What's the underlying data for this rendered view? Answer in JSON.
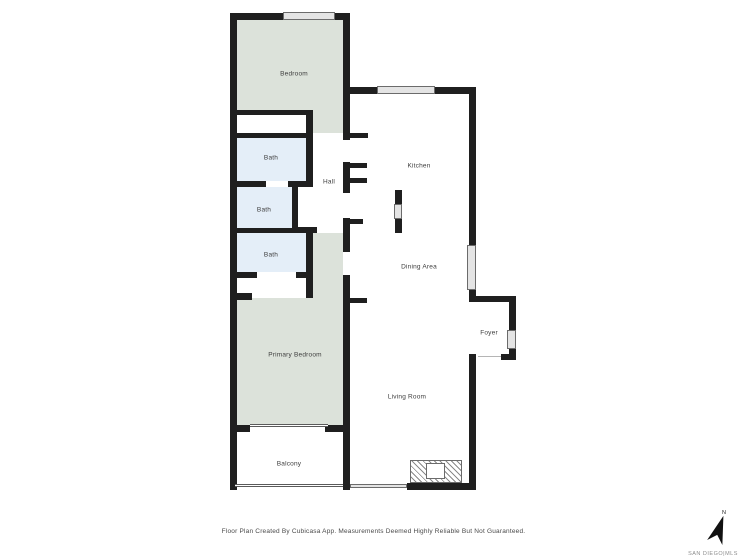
{
  "canvas": {
    "width": 747,
    "height": 560
  },
  "colors": {
    "wall": "#1f1f1f",
    "room_green": "#dce2da",
    "room_blue": "#e4eef8",
    "window_fill": "#e4e4e4",
    "window_border": "#6b6b6b",
    "rail_border": "#5a5a5a",
    "hatch_line": "#8a8a8a",
    "label": "#3d3d3d",
    "footer_text": "#4a4a4a",
    "brand_text": "#8d8d8d"
  },
  "rooms": [
    {
      "name": "bedroom",
      "label": "Bedroom",
      "cx": 294,
      "cy": 74
    },
    {
      "name": "bath-upper",
      "label": "Bath",
      "cx": 271,
      "cy": 158
    },
    {
      "name": "hall",
      "label": "Hall",
      "cx": 329,
      "cy": 182
    },
    {
      "name": "bath-middle",
      "label": "Bath",
      "cx": 264,
      "cy": 210
    },
    {
      "name": "bath-lower",
      "label": "Bath",
      "cx": 271,
      "cy": 255
    },
    {
      "name": "kitchen",
      "label": "Kitchen",
      "cx": 419,
      "cy": 166
    },
    {
      "name": "dining-area",
      "label": "Dining Area",
      "cx": 419,
      "cy": 267
    },
    {
      "name": "foyer",
      "label": "Foyer",
      "cx": 489,
      "cy": 333
    },
    {
      "name": "primary-bedroom",
      "label": "Primary Bedroom",
      "cx": 295,
      "cy": 355
    },
    {
      "name": "living-room",
      "label": "Living Room",
      "cx": 407,
      "cy": 397
    },
    {
      "name": "balcony",
      "label": "Balcony",
      "cx": 289,
      "cy": 464
    }
  ],
  "footer": {
    "disclaimer": "Floor Plan Created By Cubicasa App. Measurements Deemed Highly Reliable But Not Guaranteed."
  },
  "branding": {
    "north_label": "N",
    "mls_label": "SAN DIEGO|MLS"
  },
  "geometry": {
    "fills": [
      {
        "name": "bedroom-fill",
        "color": "green",
        "rect": [
          237,
          20,
          106,
          90
        ]
      },
      {
        "name": "bedroom-fill",
        "color": "green",
        "rect": [
          313,
          110,
          30,
          23
        ]
      },
      {
        "name": "bath-upper-fill",
        "color": "blue",
        "rect": [
          237,
          138,
          69,
          43
        ]
      },
      {
        "name": "bath-middle-fill",
        "color": "blue",
        "rect": [
          237,
          187,
          55,
          41
        ]
      },
      {
        "name": "bath-lower-fill",
        "color": "blue",
        "rect": [
          237,
          233,
          69,
          39
        ]
      },
      {
        "name": "primary-bedroom-fill",
        "color": "green",
        "rect": [
          313,
          233,
          30,
          192
        ]
      },
      {
        "name": "primary-bedroom-fill",
        "color": "green",
        "rect": [
          237,
          298,
          76,
          127
        ]
      }
    ],
    "walls": [
      [
        230,
        13,
        7,
        477
      ],
      [
        230,
        13,
        120,
        7
      ],
      [
        343,
        13,
        7,
        127
      ],
      [
        343,
        162,
        7,
        31
      ],
      [
        343,
        218,
        7,
        34
      ],
      [
        343,
        275,
        7,
        215
      ],
      [
        343,
        87,
        133,
        7
      ],
      [
        469,
        87,
        7,
        215
      ],
      [
        469,
        296,
        47,
        6
      ],
      [
        509,
        296,
        7,
        64
      ],
      [
        501,
        354,
        15,
        6
      ],
      [
        469,
        354,
        7,
        136
      ],
      [
        407,
        483,
        69,
        7
      ],
      [
        230,
        110,
        82,
        5
      ],
      [
        306,
        110,
        7,
        77
      ],
      [
        230,
        133,
        83,
        5
      ],
      [
        230,
        181,
        36,
        6
      ],
      [
        288,
        181,
        18,
        6
      ],
      [
        292,
        183,
        6,
        50
      ],
      [
        292,
        227,
        25,
        6
      ],
      [
        230,
        228,
        68,
        5
      ],
      [
        306,
        233,
        7,
        65
      ],
      [
        230,
        272,
        27,
        6
      ],
      [
        296,
        272,
        17,
        6
      ],
      [
        230,
        293,
        22,
        7
      ],
      [
        230,
        425,
        20,
        7
      ],
      [
        325,
        425,
        18,
        7
      ],
      [
        350,
        133,
        18,
        5
      ],
      [
        350,
        163,
        17,
        5
      ],
      [
        350,
        178,
        17,
        5
      ],
      [
        350,
        219,
        13,
        5
      ],
      [
        350,
        298,
        17,
        5
      ]
    ],
    "windows": [
      [
        283,
        12,
        52,
        8
      ],
      [
        377,
        86,
        58,
        8
      ],
      [
        467,
        245,
        9,
        45
      ],
      [
        507,
        330,
        9,
        19
      ]
    ],
    "railings": [
      [
        235,
        484,
        108,
        3
      ],
      [
        250,
        424,
        78,
        3
      ]
    ],
    "sliders": [
      [
        350,
        484,
        57,
        4
      ]
    ],
    "door_lines": [
      [
        478,
        356,
        23,
        1
      ]
    ],
    "island": {
      "top": [
        395,
        190,
        7,
        14
      ],
      "mid": [
        394,
        204,
        8,
        15
      ],
      "bottom": [
        395,
        219,
        7,
        14
      ]
    },
    "hatch": {
      "outer": [
        410,
        460,
        52,
        23
      ],
      "inner": [
        426,
        463,
        19,
        16
      ]
    }
  }
}
